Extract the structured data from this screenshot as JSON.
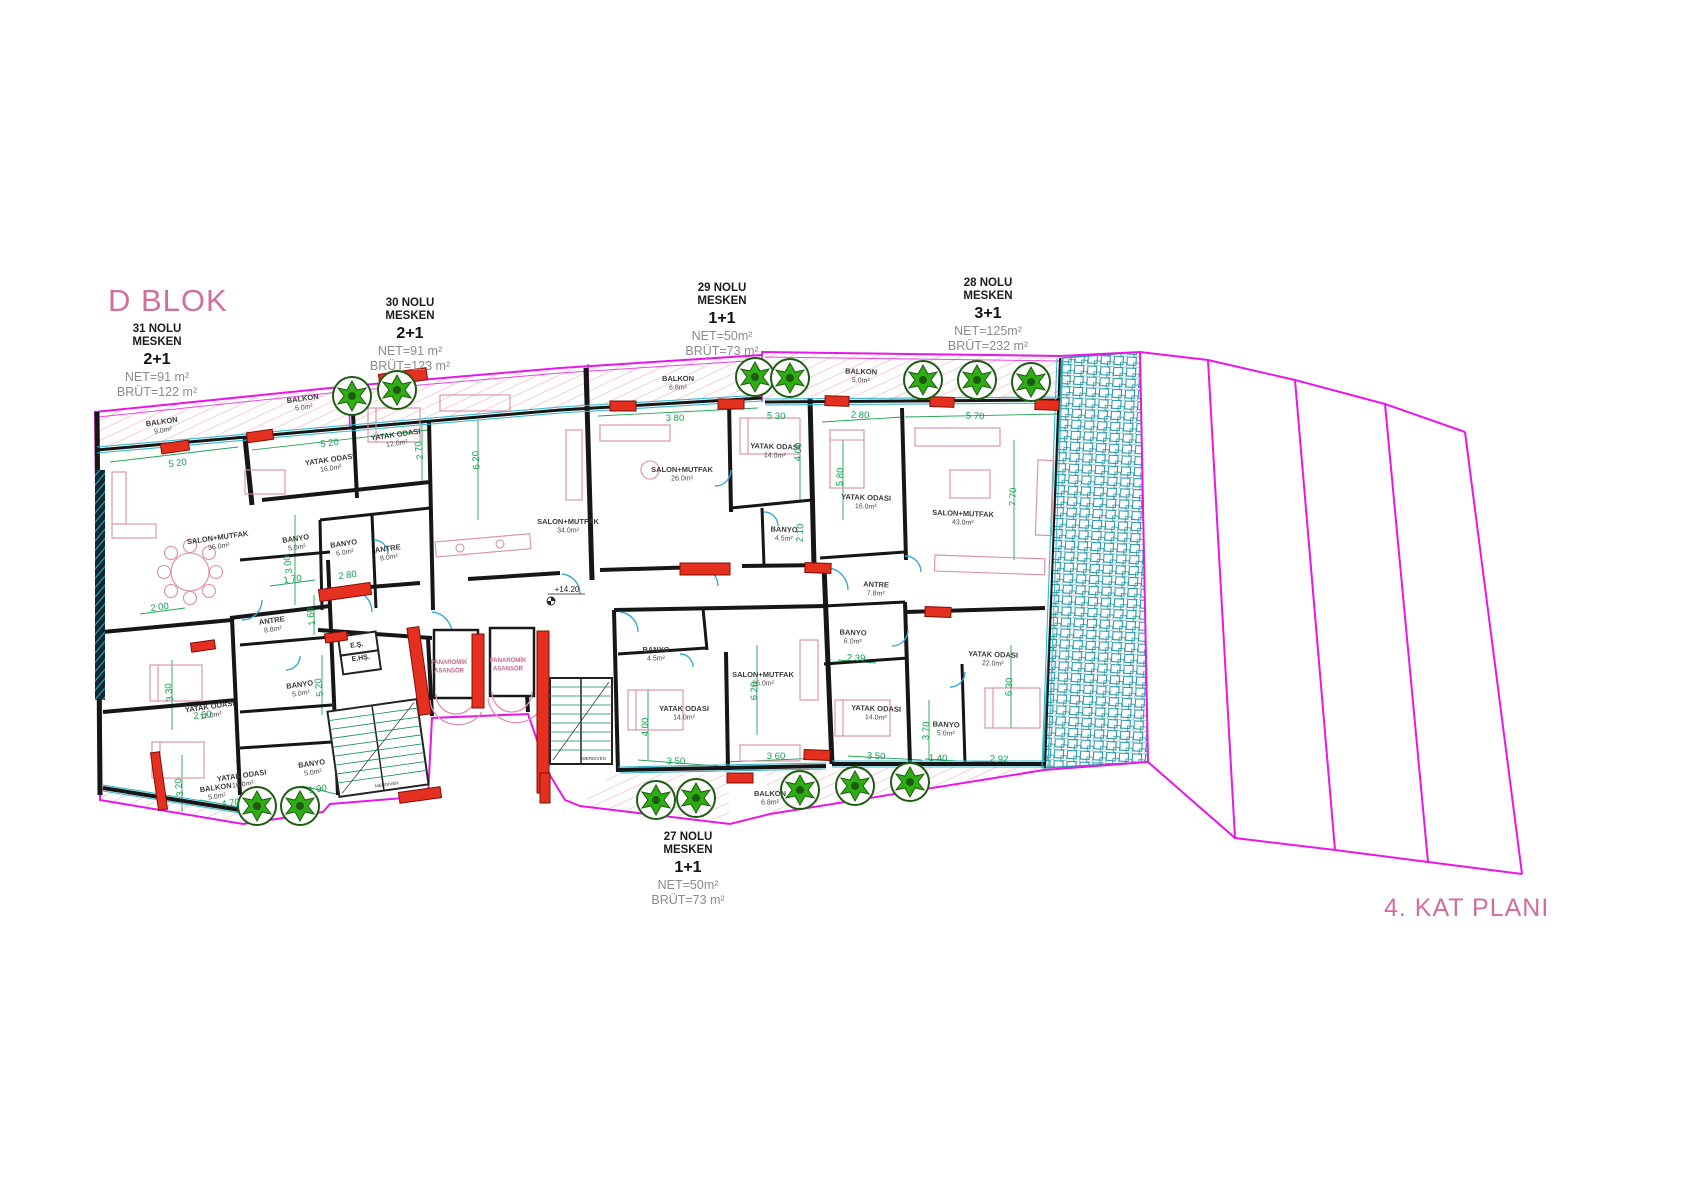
{
  "block_title": "D BLOK",
  "plan_title": "4. KAT PLANI",
  "level_marker": "+14.20",
  "units": [
    {
      "no": "31 NOLU",
      "mesken": "MESKEN",
      "type": "2+1",
      "net": "NET=91 m²",
      "brut": "BRÜT=122 m²"
    },
    {
      "no": "30 NOLU",
      "mesken": "MESKEN",
      "type": "2+1",
      "net": "NET=91 m²",
      "brut": "BRÜT=123 m²"
    },
    {
      "no": "29 NOLU",
      "mesken": "MESKEN",
      "type": "1+1",
      "net": "NET=50m²",
      "brut": "BRÜT=73 m²"
    },
    {
      "no": "28 NOLU",
      "mesken": "MESKEN",
      "type": "3+1",
      "net": "NET=125m²",
      "brut": "BRÜT=232 m²"
    },
    {
      "no": "27 NOLU",
      "mesken": "MESKEN",
      "type": "1+1",
      "net": "NET=50m²",
      "brut": "BRÜT=73 m²"
    }
  ],
  "rooms": [
    {
      "name": "BALKON",
      "area": "9.0m²",
      "x": 162,
      "y": 424,
      "r": -8
    },
    {
      "name": "BALKON",
      "area": "5.0m²",
      "x": 303,
      "y": 401,
      "r": -8
    },
    {
      "name": "SALON+MUTFAK",
      "area": "36.0m²",
      "x": 218,
      "y": 540,
      "r": -8
    },
    {
      "name": "YATAK ODASI",
      "area": "16.0m²",
      "x": 330,
      "y": 462,
      "r": -8
    },
    {
      "name": "YATAK ODASI",
      "area": "12.0m²",
      "x": 396,
      "y": 437,
      "r": -8
    },
    {
      "name": "BANYO",
      "area": "5.0m²",
      "x": 296,
      "y": 541,
      "r": -8
    },
    {
      "name": "BANYO",
      "area": "6.0m²",
      "x": 344,
      "y": 546,
      "r": -8
    },
    {
      "name": "ANTRE",
      "area": "8.0m²",
      "x": 388,
      "y": 551,
      "r": -8
    },
    {
      "name": "ANTRE",
      "area": "8.8m²",
      "x": 272,
      "y": 623,
      "r": -8
    },
    {
      "name": "YATAK ODASI",
      "area": "12.0m²",
      "x": 210,
      "y": 709,
      "r": -8
    },
    {
      "name": "BANYO",
      "area": "5.0m²",
      "x": 300,
      "y": 687,
      "r": -8
    },
    {
      "name": "YATAK ODASI",
      "area": "16.0m²",
      "x": 242,
      "y": 778,
      "r": -8
    },
    {
      "name": "BANYO",
      "area": "5.0m²",
      "x": 312,
      "y": 766,
      "r": -8
    },
    {
      "name": "BALKON",
      "area": "5.0m²",
      "x": 216,
      "y": 790,
      "r": -8
    },
    {
      "name": "SALON+MUTFAK",
      "area": "34.0m²",
      "x": 568,
      "y": 524,
      "r": 0
    },
    {
      "name": "BALKON",
      "area": "6.8m²",
      "x": 678,
      "y": 381,
      "r": 0
    },
    {
      "name": "SALON+MUTFAK",
      "area": "26.0m²",
      "x": 682,
      "y": 472,
      "r": 0
    },
    {
      "name": "YATAK ODASI",
      "area": "14.0m²",
      "x": 775,
      "y": 449,
      "r": 2
    },
    {
      "name": "BANYO",
      "area": "4.5m²",
      "x": 784,
      "y": 532,
      "r": 2
    },
    {
      "name": "BALKON",
      "area": "5.0m²",
      "x": 861,
      "y": 374,
      "r": 2
    },
    {
      "name": "YATAK ODASI",
      "area": "16.0m²",
      "x": 866,
      "y": 500,
      "r": 2
    },
    {
      "name": "SALON+MUTFAK",
      "area": "43.0m²",
      "x": 963,
      "y": 516,
      "r": 2
    },
    {
      "name": "ANTRE",
      "area": "7.8m²",
      "x": 876,
      "y": 587,
      "r": 2
    },
    {
      "name": "BANYO",
      "area": "6.0m²",
      "x": 853,
      "y": 635,
      "r": 2
    },
    {
      "name": "YATAK ODASI",
      "area": "14.0m²",
      "x": 876,
      "y": 711,
      "r": 2
    },
    {
      "name": "BANYO",
      "area": "5.0m²",
      "x": 946,
      "y": 727,
      "r": 2
    },
    {
      "name": "YATAK ODASI",
      "area": "22.0m²",
      "x": 993,
      "y": 657,
      "r": 2
    },
    {
      "name": "BANYO",
      "area": "4.5m²",
      "x": 656,
      "y": 652,
      "r": 0
    },
    {
      "name": "YATAK ODASI",
      "area": "14.0m²",
      "x": 684,
      "y": 711,
      "r": 0
    },
    {
      "name": "SALON+MUTFAK",
      "area": "26.0m²",
      "x": 763,
      "y": 677,
      "r": 0
    },
    {
      "name": "BALKON",
      "area": "6.8m²",
      "x": 770,
      "y": 796,
      "r": 0
    }
  ],
  "dims": [
    {
      "t": "5 20",
      "x": 178,
      "y": 466,
      "r": -8
    },
    {
      "t": "5 20",
      "x": 330,
      "y": 446,
      "r": -8
    },
    {
      "t": "2 70",
      "x": 422,
      "y": 450,
      "r": -98
    },
    {
      "t": "6 20",
      "x": 479,
      "y": 460,
      "r": -94
    },
    {
      "t": "3 80",
      "x": 675,
      "y": 421,
      "r": 0
    },
    {
      "t": "5 30",
      "x": 776,
      "y": 419,
      "r": 2
    },
    {
      "t": "2 80",
      "x": 860,
      "y": 418,
      "r": 2
    },
    {
      "t": "5 70",
      "x": 975,
      "y": 419,
      "r": 2
    },
    {
      "t": "5 80",
      "x": 843,
      "y": 477,
      "r": -88
    },
    {
      "t": "4 00",
      "x": 801,
      "y": 452,
      "r": -88
    },
    {
      "t": "2 10",
      "x": 803,
      "y": 533,
      "r": -88
    },
    {
      "t": "3 00",
      "x": 291,
      "y": 564,
      "r": -98
    },
    {
      "t": "1 70",
      "x": 293,
      "y": 582,
      "r": -8
    },
    {
      "t": "2 80",
      "x": 348,
      "y": 578,
      "r": -8
    },
    {
      "t": "2 00",
      "x": 160,
      "y": 610,
      "r": -8
    },
    {
      "t": "1 60",
      "x": 314,
      "y": 616,
      "r": -98
    },
    {
      "t": "3 30",
      "x": 172,
      "y": 692,
      "r": -98
    },
    {
      "t": "2 60",
      "x": 203,
      "y": 718,
      "r": -8
    },
    {
      "t": "5 20",
      "x": 322,
      "y": 687,
      "r": -98
    },
    {
      "t": "3 20",
      "x": 182,
      "y": 787,
      "r": -98
    },
    {
      "t": "1 90",
      "x": 318,
      "y": 792,
      "r": -8
    },
    {
      "t": "4 70",
      "x": 231,
      "y": 806,
      "r": -8
    },
    {
      "t": "4 00",
      "x": 648,
      "y": 727,
      "r": -90
    },
    {
      "t": "6 20",
      "x": 757,
      "y": 691,
      "r": -90
    },
    {
      "t": "3 50",
      "x": 676,
      "y": 764,
      "r": 0
    },
    {
      "t": "3 60",
      "x": 776,
      "y": 759,
      "r": 0
    },
    {
      "t": "2 39",
      "x": 856,
      "y": 661,
      "r": 2
    },
    {
      "t": "3 70",
      "x": 929,
      "y": 731,
      "r": -88
    },
    {
      "t": "6 30",
      "x": 1012,
      "y": 687,
      "r": -88
    },
    {
      "t": "7 70",
      "x": 1016,
      "y": 497,
      "r": -88
    },
    {
      "t": "3 50",
      "x": 876,
      "y": 759,
      "r": 2
    },
    {
      "t": "1 40",
      "x": 938,
      "y": 761,
      "r": 2
    },
    {
      "t": "2 92",
      "x": 999,
      "y": 762,
      "r": 2
    }
  ],
  "core_labels": [
    {
      "t": "E.Ş.",
      "x": 357,
      "y": 647,
      "r": -8,
      "cls": "core-t"
    },
    {
      "t": "E.HŞ.",
      "x": 361,
      "y": 660,
      "r": -8,
      "cls": "core-t"
    },
    {
      "t": "PANAROMİK|ASANSÖR",
      "x": 449,
      "y": 664,
      "r": 0,
      "cls": "core-pink"
    },
    {
      "t": "PANAROMİK|ASANSÖR",
      "x": 508,
      "y": 662,
      "r": 0,
      "cls": "core-pink"
    },
    {
      "t": "MERDİVEN",
      "x": 387,
      "y": 786,
      "r": -8,
      "cls": "core-tiny"
    },
    {
      "t": "MERDİVEN",
      "x": 594,
      "y": 760,
      "r": 0,
      "cls": "core-tiny"
    }
  ],
  "trees": [
    {
      "x": 352,
      "y": 396
    },
    {
      "x": 397,
      "y": 390
    },
    {
      "x": 755,
      "y": 377
    },
    {
      "x": 790,
      "y": 378
    },
    {
      "x": 923,
      "y": 380
    },
    {
      "x": 977,
      "y": 380
    },
    {
      "x": 1031,
      "y": 382
    },
    {
      "x": 257,
      "y": 806
    },
    {
      "x": 300,
      "y": 806
    },
    {
      "x": 656,
      "y": 800
    },
    {
      "x": 696,
      "y": 798
    },
    {
      "x": 800,
      "y": 790
    },
    {
      "x": 855,
      "y": 786
    },
    {
      "x": 910,
      "y": 782
    }
  ],
  "shear_walls": [
    {
      "x": 175,
      "y": 447,
      "w": 28,
      "h": 10,
      "r": -8
    },
    {
      "x": 260,
      "y": 436,
      "w": 26,
      "h": 10,
      "r": -8
    },
    {
      "x": 403,
      "y": 377,
      "w": 48,
      "h": 12,
      "r": -8
    },
    {
      "x": 345,
      "y": 592,
      "w": 52,
      "h": 12,
      "r": -8
    },
    {
      "x": 203,
      "y": 646,
      "w": 24,
      "h": 9,
      "r": -8
    },
    {
      "x": 336,
      "y": 637,
      "w": 22,
      "h": 9,
      "r": -8
    },
    {
      "x": 159,
      "y": 781,
      "w": 9,
      "h": 58,
      "r": -8
    },
    {
      "x": 419,
      "y": 671,
      "w": 12,
      "h": 88,
      "r": -8
    },
    {
      "x": 478,
      "y": 671,
      "w": 12,
      "h": 74,
      "r": 0
    },
    {
      "x": 543,
      "y": 712,
      "w": 12,
      "h": 162,
      "r": 0
    },
    {
      "x": 420,
      "y": 795,
      "w": 42,
      "h": 11,
      "r": -8
    },
    {
      "x": 545,
      "y": 788,
      "w": 10,
      "h": 30,
      "r": 0
    },
    {
      "x": 623,
      "y": 406,
      "w": 26,
      "h": 10,
      "r": 0
    },
    {
      "x": 731,
      "y": 404,
      "w": 26,
      "h": 10,
      "r": 0
    },
    {
      "x": 837,
      "y": 401,
      "w": 24,
      "h": 10,
      "r": 2
    },
    {
      "x": 942,
      "y": 402,
      "w": 24,
      "h": 10,
      "r": 2
    },
    {
      "x": 1047,
      "y": 405,
      "w": 24,
      "h": 10,
      "r": 2
    },
    {
      "x": 705,
      "y": 569,
      "w": 50,
      "h": 12,
      "r": 0
    },
    {
      "x": 818,
      "y": 568,
      "w": 26,
      "h": 10,
      "r": 2
    },
    {
      "x": 938,
      "y": 612,
      "w": 26,
      "h": 10,
      "r": 2
    },
    {
      "x": 740,
      "y": 778,
      "w": 26,
      "h": 10,
      "r": 0
    },
    {
      "x": 817,
      "y": 755,
      "w": 26,
      "h": 10,
      "r": 2
    }
  ],
  "colors": {
    "boundary_magenta": "#e816e8",
    "title_pink": "#d06f9c",
    "dim_green": "#0f9f4e",
    "wall_black": "#161616",
    "window_cyan": "#35b8cc",
    "door_blue": "#3aa8d6",
    "shear_red": "#e53020",
    "tree_green": "#2fae14",
    "furniture_pink": "#da8da6",
    "terrace_teal": "#2a98a8"
  }
}
